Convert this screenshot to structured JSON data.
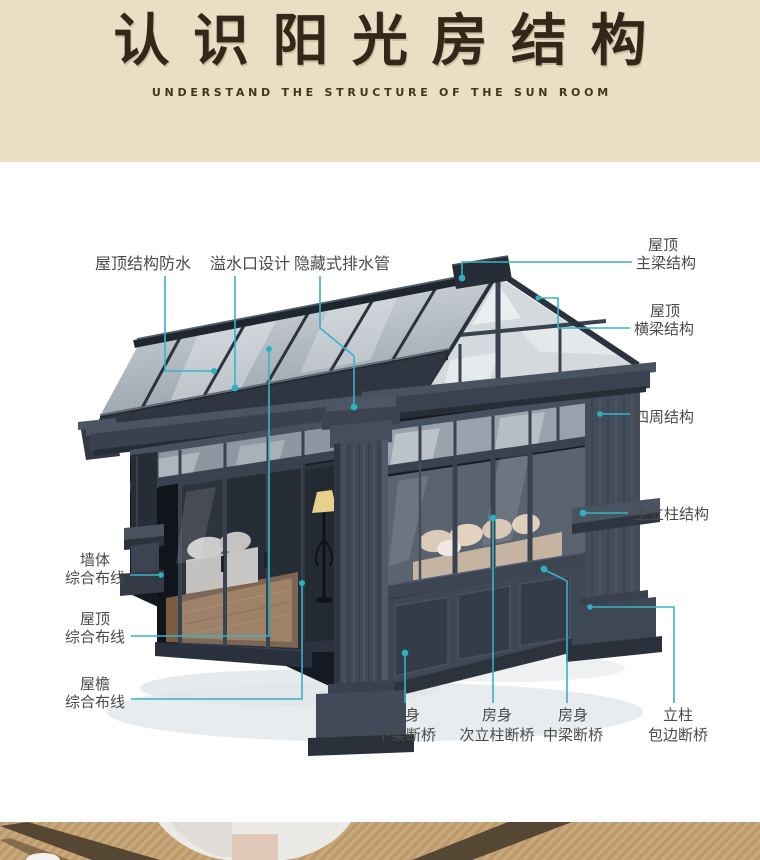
{
  "header": {
    "title": "认识阳光房结构",
    "subtitle": "UNDERSTAND THE STRUCTURE OF THE SUN ROOM"
  },
  "callouts": {
    "roof_waterproof": {
      "text": "屋顶结构防水"
    },
    "overflow": {
      "text": "溢水口设计"
    },
    "drain": {
      "text": "隐藏式排水管"
    },
    "main_beam": {
      "line1": "屋顶",
      "line2": "主梁结构"
    },
    "cross_beam": {
      "line1": "屋顶",
      "line2": "横梁结构"
    },
    "surround": {
      "text": "四周结构"
    },
    "main_column": {
      "text": "主立柱结构"
    },
    "wall_wiring": {
      "line1": "墙体",
      "line2": "综合布线"
    },
    "roof_wiring": {
      "line1": "屋顶",
      "line2": "综合布线"
    },
    "eave_wiring": {
      "line1": "屋檐",
      "line2": "综合布线"
    },
    "lower_beam": {
      "line1": "房身",
      "line2": "下梁断桥"
    },
    "sub_column": {
      "line1": "房身",
      "line2": "次立柱断桥"
    },
    "mid_beam": {
      "line1": "房身",
      "line2": "中梁断桥"
    },
    "column_edge": {
      "line1": "立柱",
      "line2": "包边断桥"
    }
  },
  "colors": {
    "header_bg": "#eadfc4",
    "title_text": "#33271a",
    "label_text": "#4a4a4a",
    "accent_line": "#38b3c5",
    "frame_dark": "#3e4654"
  }
}
